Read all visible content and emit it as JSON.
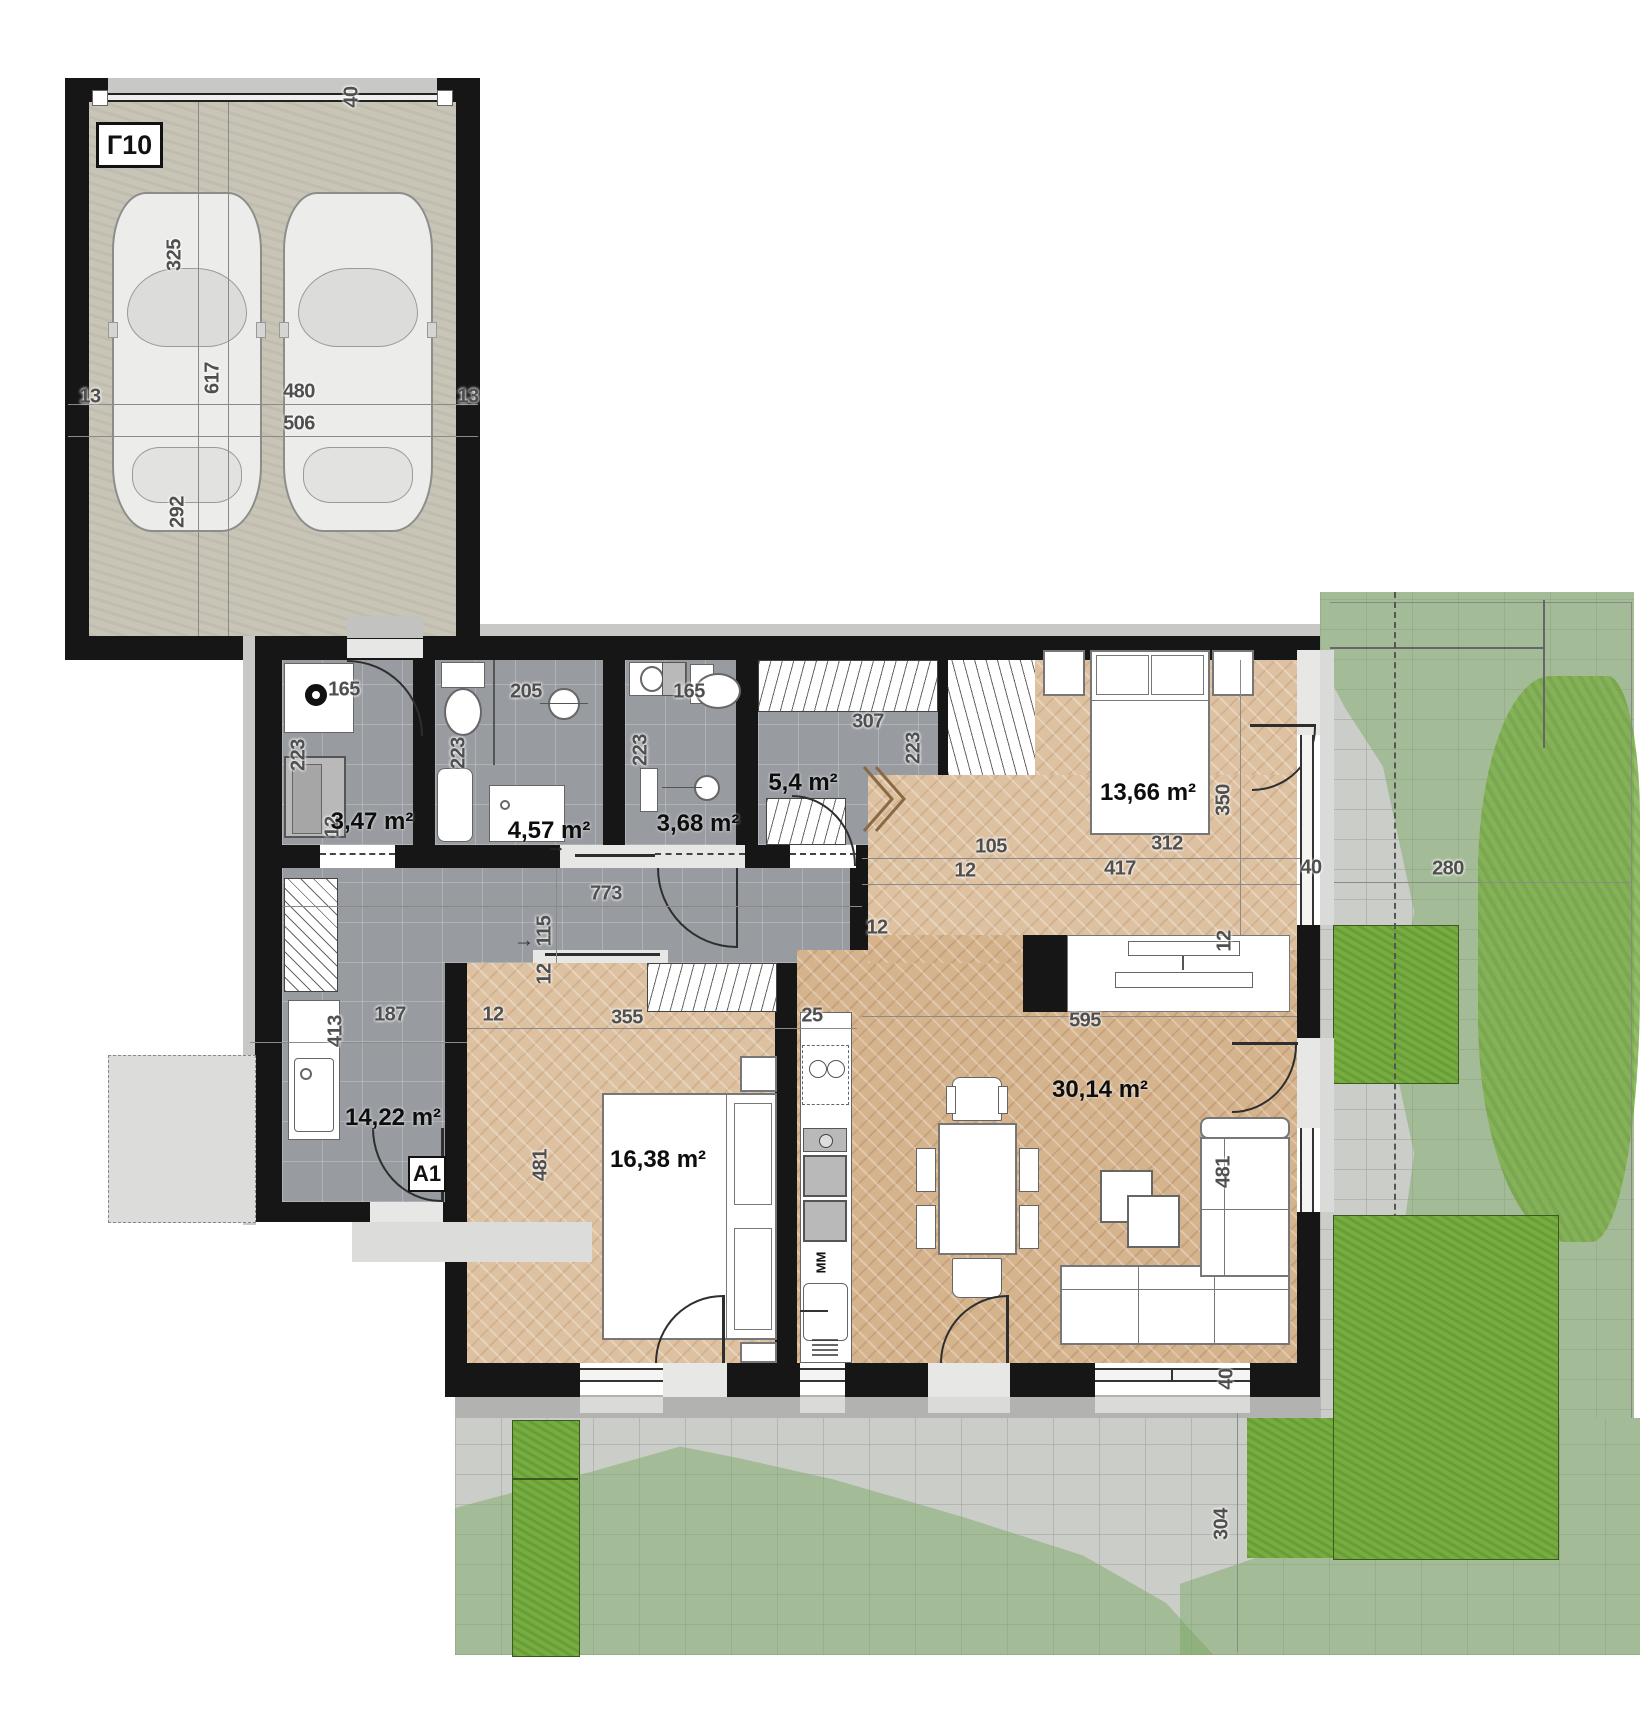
{
  "plan_title": "Apartment A1 with garage Г10 — ground floor plan",
  "garage": {
    "label": "Г10"
  },
  "entrance": {
    "label": "A1"
  },
  "kitchen": {
    "dishwasher_label": "ММ"
  },
  "colors": {
    "wall": "#161616",
    "tile_floor": "#989ca1",
    "parquet_light": "#ddc1a1",
    "parquet_dark": "#d5b38d",
    "garage_concrete": "#c8c4b6",
    "pavers": "#cbcdc9",
    "lawn_overlay": "#7aa860",
    "hedge_green": "#76ad3f"
  },
  "rooms": [
    {
      "id": "laundry",
      "area_label": "3,47 m²"
    },
    {
      "id": "bathroom",
      "area_label": "4,57 m²"
    },
    {
      "id": "wc",
      "area_label": "3,68 m²"
    },
    {
      "id": "wardrobe",
      "area_label": "5,4 m²"
    },
    {
      "id": "bedroom-1",
      "area_label": "13,66 m²"
    },
    {
      "id": "hallway",
      "area_label": "14,22 m²"
    },
    {
      "id": "bedroom-2",
      "area_label": "16,38 m²"
    },
    {
      "id": "living-room",
      "area_label": "30,14 m²"
    }
  ],
  "area_labels": [
    {
      "text": "3,47 m²",
      "x": 372,
      "y": 822
    },
    {
      "text": "4,57 m²",
      "x": 549,
      "y": 831
    },
    {
      "text": "3,68 m²",
      "x": 698,
      "y": 824
    },
    {
      "text": "5,4 m²",
      "x": 803,
      "y": 783
    },
    {
      "text": "13,66 m²",
      "x": 1148,
      "y": 793
    },
    {
      "text": "14,22 m²",
      "x": 393,
      "y": 1118
    },
    {
      "text": "16,38 m²",
      "x": 658,
      "y": 1160
    },
    {
      "text": "30,14 m²",
      "x": 1100,
      "y": 1090
    }
  ],
  "dimensions": [
    {
      "text": "40",
      "x": 352,
      "y": 97,
      "rot": true
    },
    {
      "text": "325",
      "x": 175,
      "y": 255,
      "rot": true
    },
    {
      "text": "617",
      "x": 213,
      "y": 378,
      "rot": true
    },
    {
      "text": "292",
      "x": 178,
      "y": 512,
      "rot": true
    },
    {
      "text": "13",
      "x": 90,
      "y": 397,
      "rot": false
    },
    {
      "text": "480",
      "x": 299,
      "y": 392,
      "rot": false
    },
    {
      "text": "506",
      "x": 299,
      "y": 424,
      "rot": false
    },
    {
      "text": "13",
      "x": 468,
      "y": 397,
      "rot": false
    },
    {
      "text": "165",
      "x": 344,
      "y": 690,
      "rot": false
    },
    {
      "text": "223",
      "x": 299,
      "y": 755,
      "rot": true
    },
    {
      "text": "12",
      "x": 333,
      "y": 827,
      "rot": true
    },
    {
      "text": "205",
      "x": 526,
      "y": 692,
      "rot": false
    },
    {
      "text": "223",
      "x": 459,
      "y": 753,
      "rot": true
    },
    {
      "text": "165",
      "x": 689,
      "y": 692,
      "rot": false
    },
    {
      "text": "223",
      "x": 641,
      "y": 750,
      "rot": true
    },
    {
      "text": "307",
      "x": 868,
      "y": 722,
      "rot": false
    },
    {
      "text": "223",
      "x": 914,
      "y": 748,
      "rot": true
    },
    {
      "text": "773",
      "x": 606,
      "y": 894,
      "rot": false
    },
    {
      "text": "115",
      "x": 545,
      "y": 931,
      "rot": true
    },
    {
      "text": "12",
      "x": 877,
      "y": 928,
      "rot": false
    },
    {
      "text": "413",
      "x": 336,
      "y": 1031,
      "rot": true
    },
    {
      "text": "187",
      "x": 390,
      "y": 1015,
      "rot": false
    },
    {
      "text": "12",
      "x": 493,
      "y": 1015,
      "rot": false
    },
    {
      "text": "105",
      "x": 991,
      "y": 847,
      "rot": false
    },
    {
      "text": "312",
      "x": 1167,
      "y": 844,
      "rot": false
    },
    {
      "text": "12",
      "x": 965,
      "y": 871,
      "rot": false
    },
    {
      "text": "417",
      "x": 1120,
      "y": 869,
      "rot": false
    },
    {
      "text": "350",
      "x": 1224,
      "y": 800,
      "rot": true
    },
    {
      "text": "40",
      "x": 1311,
      "y": 868,
      "rot": false
    },
    {
      "text": "280",
      "x": 1448,
      "y": 869,
      "rot": false
    },
    {
      "text": "12",
      "x": 1225,
      "y": 941,
      "rot": true
    },
    {
      "text": "595",
      "x": 1085,
      "y": 1021,
      "rot": false
    },
    {
      "text": "12",
      "x": 545,
      "y": 974,
      "rot": true
    },
    {
      "text": "355",
      "x": 627,
      "y": 1018,
      "rot": false
    },
    {
      "text": "25",
      "x": 812,
      "y": 1016,
      "rot": false
    },
    {
      "text": "481",
      "x": 541,
      "y": 1165,
      "rot": true
    },
    {
      "text": "481",
      "x": 1224,
      "y": 1172,
      "rot": true
    },
    {
      "text": "40",
      "x": 1227,
      "y": 1379,
      "rot": true
    },
    {
      "text": "304",
      "x": 1222,
      "y": 1524,
      "rot": true
    }
  ]
}
